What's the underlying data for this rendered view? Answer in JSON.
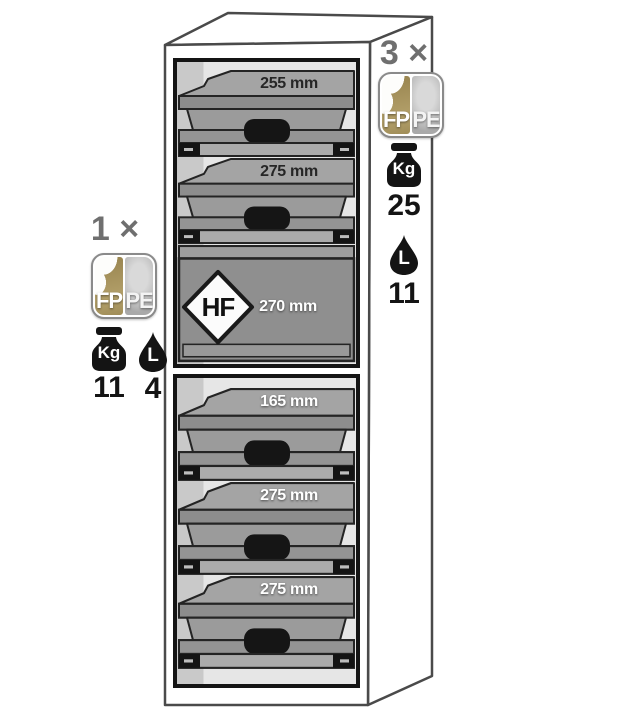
{
  "cabinet": {
    "top_compartment": {
      "trays": [
        {
          "depth_label": "255 mm"
        },
        {
          "depth_label": "275 mm"
        }
      ],
      "sump": {
        "hazard_code": "HF",
        "depth_label": "270 mm"
      }
    },
    "bottom_compartment": {
      "trays": [
        {
          "depth_label": "165 mm"
        },
        {
          "depth_label": "275 mm"
        },
        {
          "depth_label": "275 mm"
        }
      ]
    }
  },
  "annotations": {
    "left": {
      "count": "1 ×",
      "badge": {
        "left_label": "FP",
        "right_label": "PE"
      },
      "weight": {
        "unit": "Kg",
        "value": "11"
      },
      "volume": {
        "unit": "L",
        "value": "4"
      }
    },
    "right": {
      "count": "3 ×",
      "badge": {
        "left_label": "FP",
        "right_label": "PE"
      },
      "weight": {
        "unit": "Kg",
        "value": "25"
      },
      "volume": {
        "unit": "L",
        "value": "11"
      }
    }
  },
  "icons": {
    "weight": "weight-kettlebell",
    "volume": "liquid-drop",
    "badge": "material-split-square"
  },
  "colors": {
    "badge_gold": "#a7955e",
    "badge_silver": "#c2c2c2",
    "icon_black": "#141414",
    "count_gray": "#6f6f6f",
    "tray_gray": "#a4a4a4",
    "frame_black": "#141414"
  }
}
